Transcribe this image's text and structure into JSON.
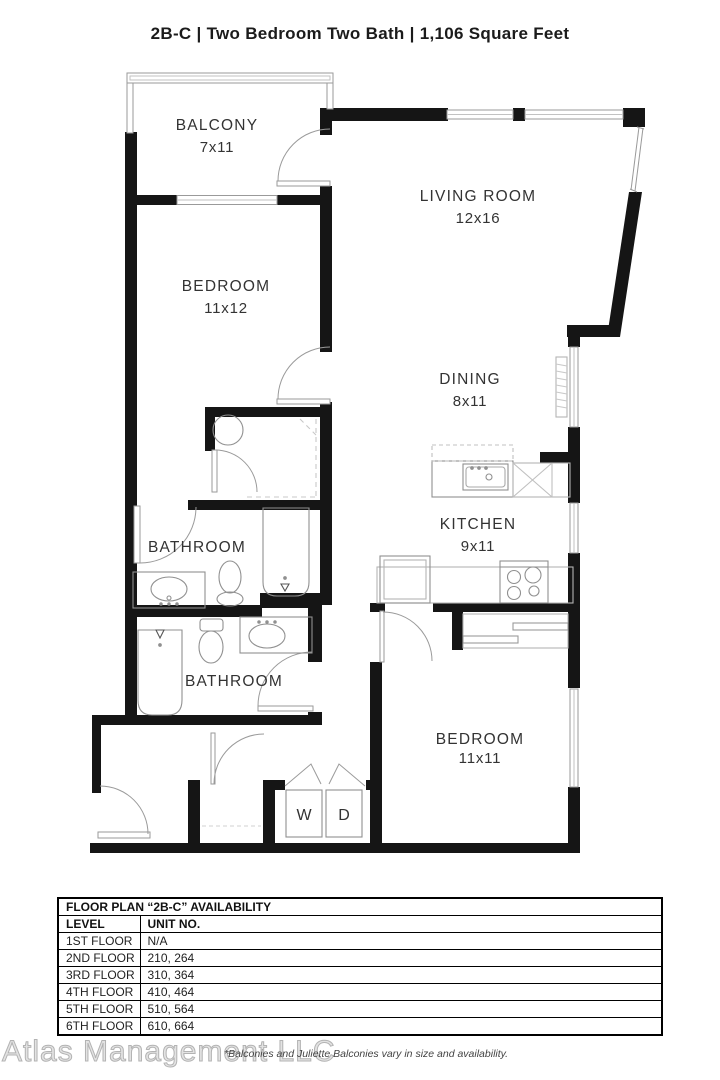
{
  "title": "2B-C | Two Bedroom Two Bath | 1,106 Square Feet",
  "plan": {
    "balcony": {
      "name": "BALCONY",
      "dims": "7x11"
    },
    "living": {
      "name": "LIVING ROOM",
      "dims": "12x16"
    },
    "bedroom1": {
      "name": "BEDROOM",
      "dims": "11x12"
    },
    "dining": {
      "name": "DINING",
      "dims": "8x11"
    },
    "kitchen": {
      "name": "KITCHEN",
      "dims": "9x11"
    },
    "bathroom1": {
      "name": "BATHROOM"
    },
    "bathroom2": {
      "name": "BATHROOM"
    },
    "bedroom2": {
      "name": "BEDROOM",
      "dims": "11x11"
    },
    "washer": "W",
    "dryer": "D"
  },
  "availability": {
    "title": "FLOOR PLAN “2B-C” AVAILABILITY",
    "columns": {
      "level": "LEVEL",
      "unit": "UNIT NO."
    },
    "rows": [
      {
        "level": "1ST FLOOR",
        "unit": "N/A"
      },
      {
        "level": "2ND FLOOR",
        "unit": "210, 264"
      },
      {
        "level": "3RD FLOOR",
        "unit": "310, 364"
      },
      {
        "level": "4TH FLOOR",
        "unit": "410, 464"
      },
      {
        "level": "5TH FLOOR",
        "unit": "510, 564"
      },
      {
        "level": "6TH FLOOR",
        "unit": "610, 664"
      }
    ]
  },
  "footer": {
    "watermark": "Atlas Management LLC",
    "disclaimer": "*Balconies and Juliette Balconies vary in size and availability."
  },
  "colors": {
    "wall": "#151515",
    "fixture": "#909090",
    "text": "#333333"
  }
}
